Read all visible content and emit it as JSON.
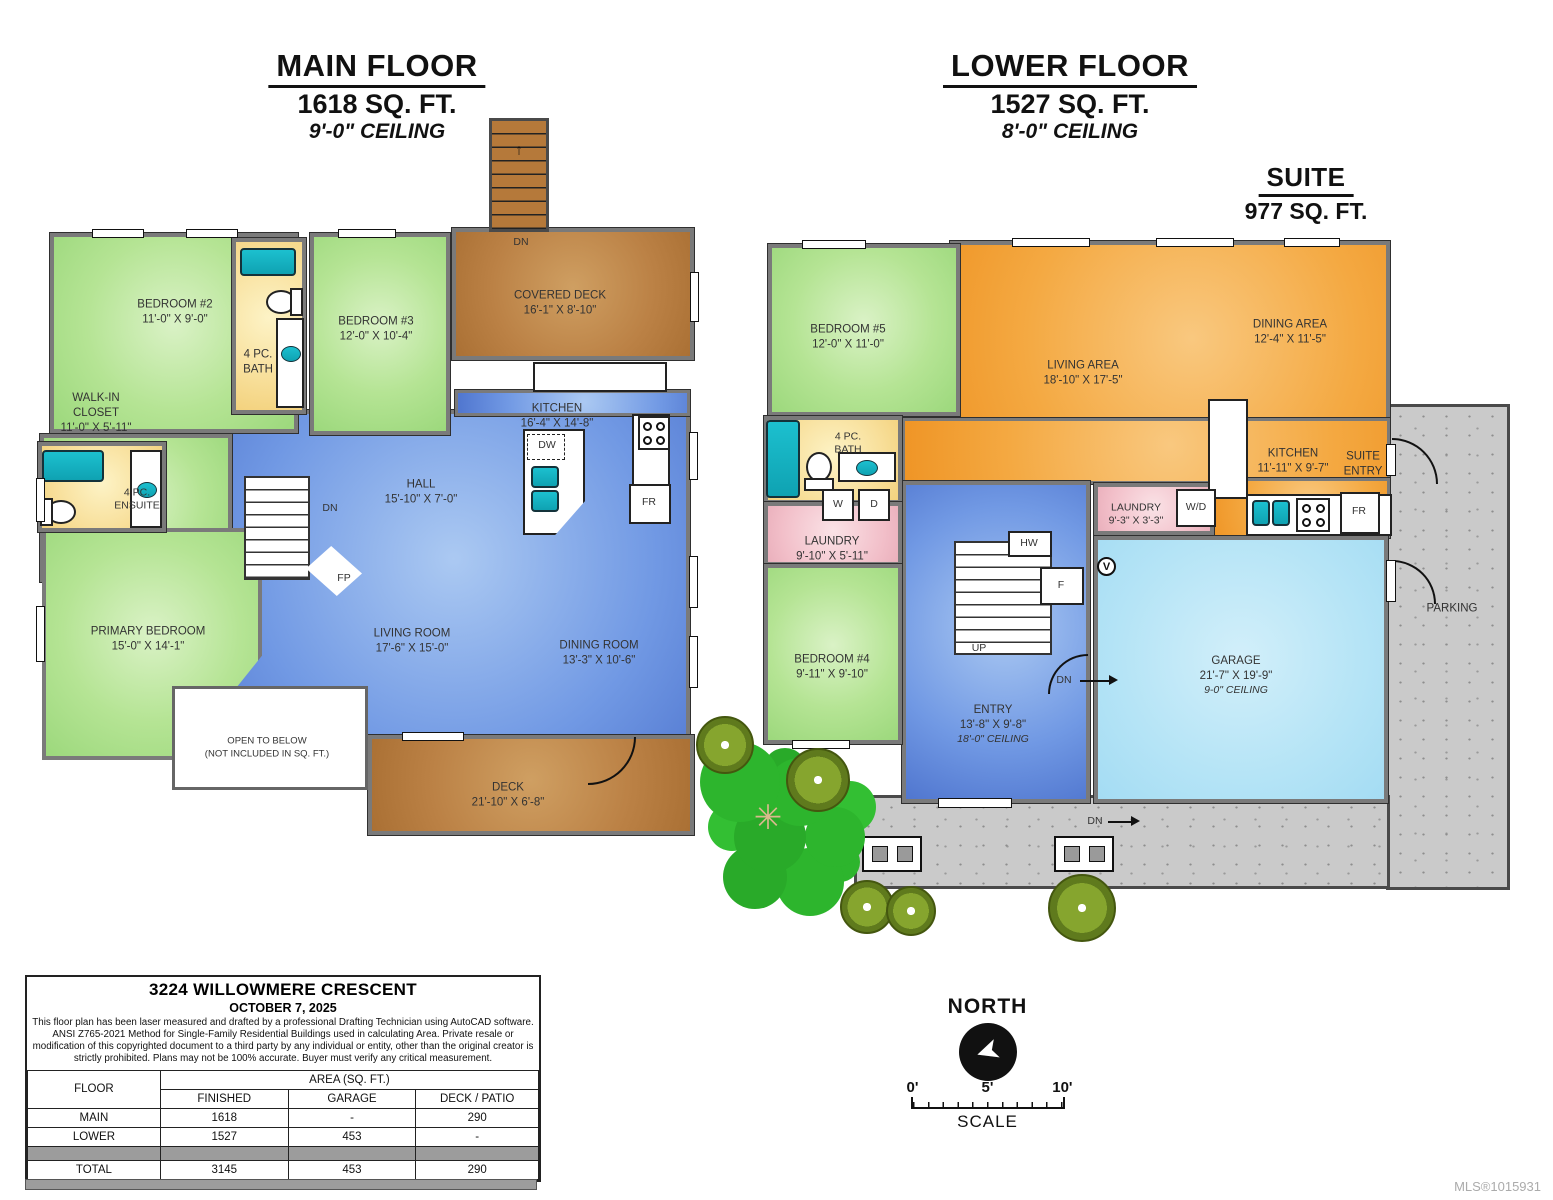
{
  "titles": {
    "main": {
      "l1": "MAIN FLOOR",
      "l2": "1618 SQ. FT.",
      "l3": "9'-0\" CEILING"
    },
    "lower": {
      "l1": "LOWER FLOOR",
      "l2": "1527 SQ. FT.",
      "l3": "8'-0\" CEILING"
    },
    "suite": {
      "l1": "SUITE",
      "l2": "977 SQ. FT."
    }
  },
  "mf": {
    "bedroom2": {
      "name": "BEDROOM #2",
      "dims": "11'-0\" X 9'-0\""
    },
    "bath": {
      "name": "4 PC.\nBATH"
    },
    "bedroom3": {
      "name": "BEDROOM #3",
      "dims": "12'-0\" X 10'-4\""
    },
    "covered_deck": {
      "name": "COVERED DECK",
      "dims": "16'-1\" X 8'-10\""
    },
    "walk_in_closet": {
      "name": "WALK-IN\nCLOSET",
      "dims": "11'-0\" X 5'-11\""
    },
    "ensuite": {
      "name": "4 PC.\nENSUITE"
    },
    "primary_bedroom": {
      "name": "PRIMARY BEDROOM",
      "dims": "15'-0\" X 14'-1\""
    },
    "hall": {
      "name": "HALL",
      "dims": "15'-10\" X 7'-0\""
    },
    "kitchen": {
      "name": "KITCHEN",
      "dims": "16'-4\" X 14'-8\""
    },
    "living_room": {
      "name": "LIVING ROOM",
      "dims": "17'-6\" X 15'-0\""
    },
    "dining_room": {
      "name": "DINING ROOM",
      "dims": "13'-3\" X 10'-6\""
    },
    "open_to_below": {
      "name": "OPEN TO BELOW",
      "note": "(NOT INCLUDED IN SQ. FT.)"
    },
    "deck": {
      "name": "DECK",
      "dims": "21'-10\" X 6'-8\""
    },
    "labels": {
      "dn_stairs": "DN",
      "dn_hall": "DN",
      "fp": "FP",
      "dw": "DW",
      "fr": "FR",
      "up_arrow": "↑"
    }
  },
  "lf": {
    "bedroom5": {
      "name": "BEDROOM #5",
      "dims": "12'-0\" X 11'-0\""
    },
    "living_area": {
      "name": "LIVING AREA",
      "dims": "18'-10\" X 17'-5\""
    },
    "dining_area": {
      "name": "DINING AREA",
      "dims": "12'-4\" X 11'-5\""
    },
    "bath": {
      "name": "4 PC.\nBATH"
    },
    "laundry_main": {
      "name": "LAUNDRY",
      "dims": "9'-10\" X 5'-11\"",
      "washer": "W",
      "dryer": "D"
    },
    "bedroom4": {
      "name": "BEDROOM #4",
      "dims": "9'-11\" X 9'-10\""
    },
    "entry": {
      "name": "ENTRY",
      "dims": "13'-8\" X 9'-8\"",
      "ceiling": "18'-0\" CEILING"
    },
    "kitchen": {
      "name": "KITCHEN",
      "dims": "11'-11\" X 9'-7\""
    },
    "suite_entry": {
      "name": "SUITE\nENTRY"
    },
    "laundry_suite": {
      "name": "LAUNDRY",
      "dims": "9'-3\" X 3'-3\"",
      "wd": "W/D"
    },
    "garage": {
      "name": "GARAGE",
      "dims": "21'-7\" X 19'-9\"",
      "ceiling": "9-0\" CEILING"
    },
    "parking": {
      "name": "PARKING"
    },
    "labels": {
      "up": "UP",
      "dn_garage": "DN",
      "dn_walk": "DN",
      "hw": "HW",
      "f": "F",
      "fr": "FR",
      "v": "V"
    }
  },
  "info": {
    "address": "3224 WILLOWMERE CRESCENT",
    "date": "OCTOBER 7, 2025",
    "disclaimer": "This floor plan has been laser measured and drafted by a professional Drafting Technician using AutoCAD software. ANSI Z765-2021 Method for Single-Family Residential Buildings used in calculating Area. Private resale or modification of this copyrighted document to a third party by any individual or entity, other than the original creator is strictly prohibited. Plans may not be 100% accurate.  Buyer must verify any critical measurement.",
    "table": {
      "floor_header": "FLOOR",
      "area_header": "AREA (SQ. FT.)",
      "col_headers": [
        "FINISHED",
        "GARAGE",
        "DECK / PATIO"
      ],
      "rows": [
        {
          "floor": "MAIN",
          "finished": "1618",
          "garage": "-",
          "deck": "290"
        },
        {
          "floor": "LOWER",
          "finished": "1527",
          "garage": "453",
          "deck": "-"
        },
        {
          "floor": "",
          "finished": "",
          "garage": "",
          "deck": ""
        },
        {
          "floor": "TOTAL",
          "finished": "3145",
          "garage": "453",
          "deck": "290"
        }
      ]
    }
  },
  "compass": {
    "north": "NORTH",
    "scale": "SCALE",
    "ticks": [
      "0'",
      "5'",
      "10'"
    ],
    "arrow_glyph": "➤",
    "tree_star": "✳"
  },
  "footer": {
    "mls": "MLS®1015931"
  },
  "colors": {
    "bedroom_green": "#b5e494",
    "living_blue": "#7199e4",
    "suite_orange": "#f4a942",
    "deck_brown": "#bb8145",
    "garage_cyan": "#b5e4f6",
    "bath_yellow": "#f8e09c",
    "laundry_pink": "#f2bfc9",
    "fixture_teal": "#16b2c3",
    "wall_gray": "#7a7a7a",
    "concrete": "#cacaca"
  }
}
